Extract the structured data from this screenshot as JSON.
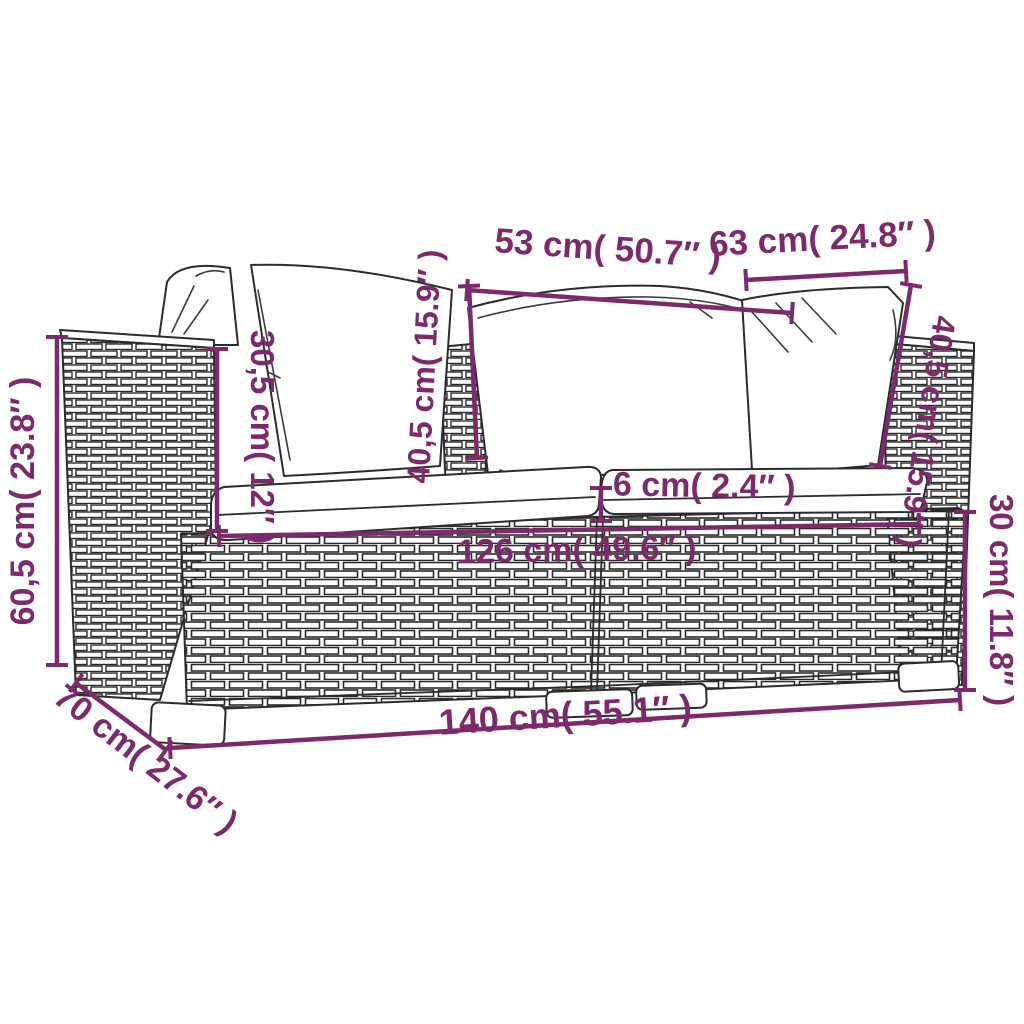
{
  "diagram": {
    "colors": {
      "accent": "#7C2A6B",
      "line": "#2B2B2B",
      "background": "#FFFFFF"
    },
    "dimensions": {
      "pillow_width_left": "53 cm( 50.7″ )",
      "pillow_width_right": "63 cm( 24.8″ )",
      "pillow_height_left": "40,5 cm( 15.9″ )",
      "pillow_height_right": "40,5 cm( 15.9″ )",
      "armrest_height": "30,5 cm( 12″ )",
      "total_height": "60,5 cm( 23.8″ )",
      "seat_cushion_thickness": "6 cm( 2.4″ )",
      "seat_width": "126 cm( 49.6″ )",
      "base_height": "30 cm( 11.8″ )",
      "total_width": "140 cm( 55.1″ )",
      "total_depth": "70 cm( 27.6″ )"
    }
  }
}
